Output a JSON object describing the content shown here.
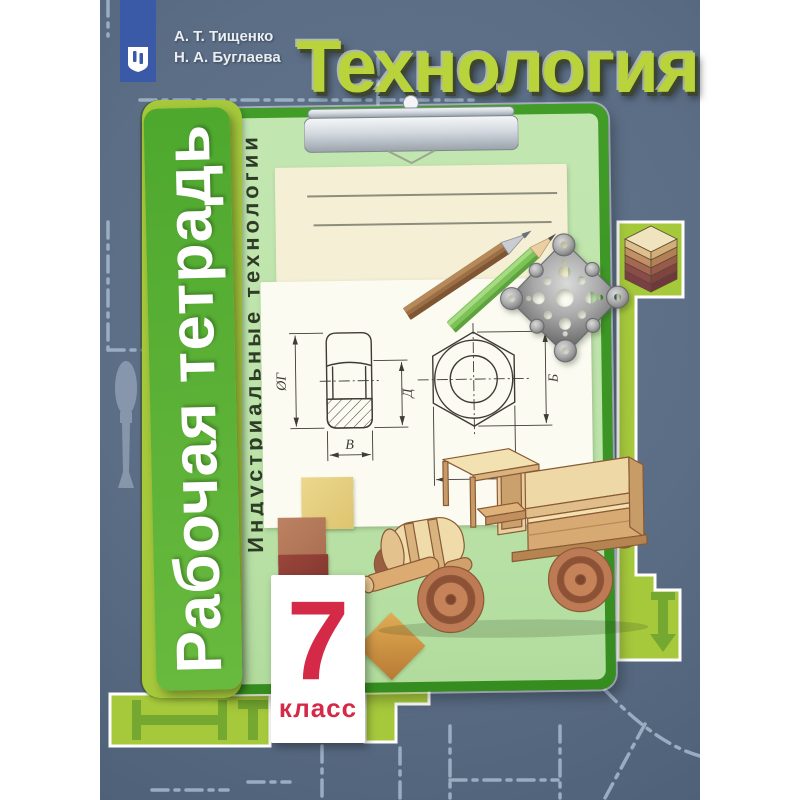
{
  "palette": {
    "page_bg": "#ffffff",
    "cover_bg": "#5c6e86",
    "cover_bg_deep": "#4f6178",
    "dash_blue": "#a4bacd",
    "chartreuse": "#a6c93c",
    "ibeam_green": "#6fa52f",
    "clipboard_green": "#419c28",
    "clipboard_green_dark": "#368d1f",
    "spine_green": "#4ea82e",
    "spine_green_light": "#68ba3e",
    "board_light_green": "#bce3a9",
    "paper_cream": "#f5efd5",
    "paper_white": "#fbfbf2",
    "writing_line": "#8d8d7e",
    "title_green": "#b9d43a",
    "title_shadow": "#3e4530",
    "logo_blue": "#3a5aa8",
    "author_text": "#eaeef5",
    "subtitle_text": "#2e3b26",
    "grade_red": "#d42a48",
    "drawing_ink": "#3f3b35"
  },
  "header": {
    "authors": [
      "А. Т. Тищенко",
      "Н. А. Буглаева"
    ],
    "title": "Технология"
  },
  "logo": {
    "icon": "prosveshchenie-emblem"
  },
  "spine": {
    "label": "Рабочая тетрадь"
  },
  "board": {
    "subtitle": "Индустриальные технологии",
    "name_lines": 2
  },
  "drawing_labels": {
    "side_diameter": "ØГ",
    "side_height": "Д",
    "side_width": "В",
    "front_height": "Б",
    "front_width": "А"
  },
  "grade_badge": {
    "number": "7",
    "label": "класс"
  },
  "illustrations": {
    "clip": "clipboard-metal-clip",
    "pencils": "two-pencils",
    "ornament": "metal-openwork-ornament",
    "truck": "wooden-toy-truck",
    "plywood": "plywood-layer-stack",
    "squares": "wooden-squares",
    "chisel": "chisel-silhouette",
    "ibeam": "i-beam-profile"
  }
}
